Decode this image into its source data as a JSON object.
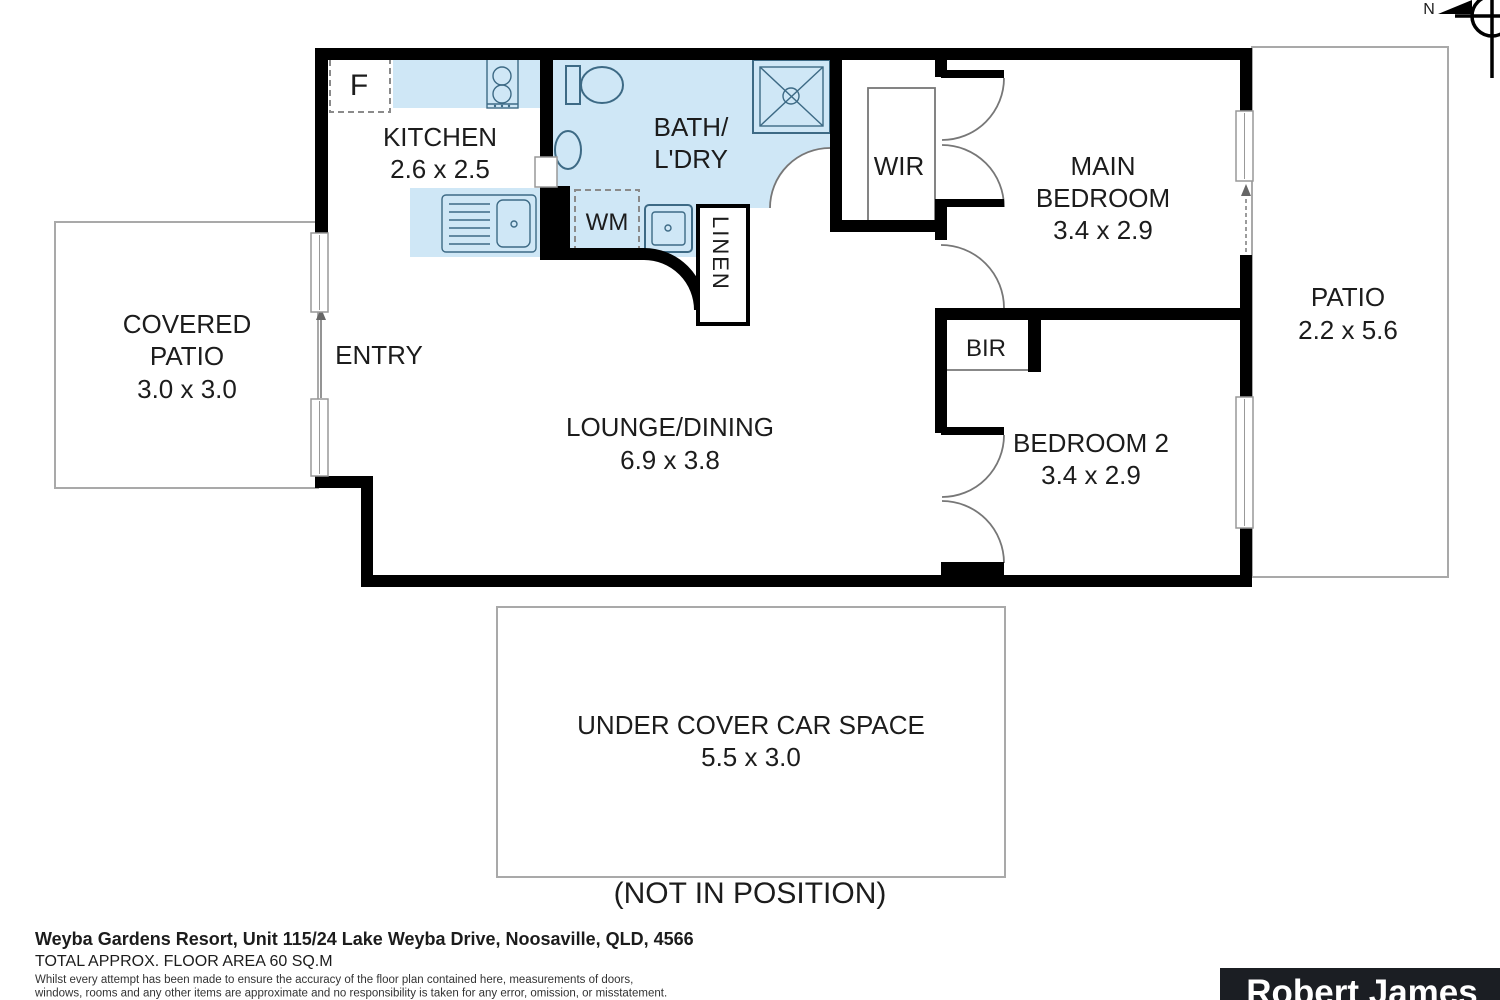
{
  "compass": {
    "north_label": "N"
  },
  "rooms": {
    "kitchen": {
      "name": "KITCHEN",
      "dims": "2.6 x 2.5"
    },
    "bath_laundry": {
      "line1": "BATH/",
      "line2": "L'DRY"
    },
    "wir": {
      "name": "WIR"
    },
    "main_bedroom": {
      "line1": "MAIN",
      "line2": "BEDROOM",
      "dims": "3.4 x 2.9"
    },
    "patio": {
      "name": "PATIO",
      "dims": "2.2 x 5.6"
    },
    "covered_patio": {
      "line1": "COVERED",
      "line2": "PATIO",
      "dims": "3.0 x 3.0"
    },
    "entry": {
      "name": "ENTRY"
    },
    "lounge_dining": {
      "name": "LOUNGE/DINING",
      "dims": "6.9 x 3.8"
    },
    "bir": {
      "name": "BIR"
    },
    "bedroom2": {
      "name": "BEDROOM 2",
      "dims": "3.4 x 2.9"
    },
    "linen": {
      "name": "LINEN"
    },
    "wm": {
      "name": "WM"
    },
    "fridge": {
      "name": "F"
    },
    "car_space": {
      "name": "UNDER COVER CAR SPACE",
      "dims": "5.5 x 3.0",
      "note": "(NOT IN POSITION)"
    }
  },
  "footer": {
    "address": "Weyba Gardens Resort, Unit 115/24 Lake Weyba Drive, Noosaville, QLD, 4566",
    "area": "TOTAL APPROX. FLOOR AREA 60 SQ.M",
    "disclaimer_line1": "Whilst every attempt has been made to ensure the accuracy of the floor plan contained here, measurements of doors,",
    "disclaimer_line2": "windows, rooms and any other items are approximate and no responsibility is taken for any error, omission, or misstatement.",
    "disclaimer_line3": "This plan is for illustrative purposes only and should be used as such by any prospective purchaser."
  },
  "logo": {
    "brand": "Robert James"
  },
  "colors": {
    "wall": "#000000",
    "wet_area_fill": "#cfe7f6",
    "fixture_stroke": "#3d6a85",
    "outline_gray": "#a9a9a9",
    "logo_bg": "#1b1e23",
    "text": "#1c1c1c"
  }
}
